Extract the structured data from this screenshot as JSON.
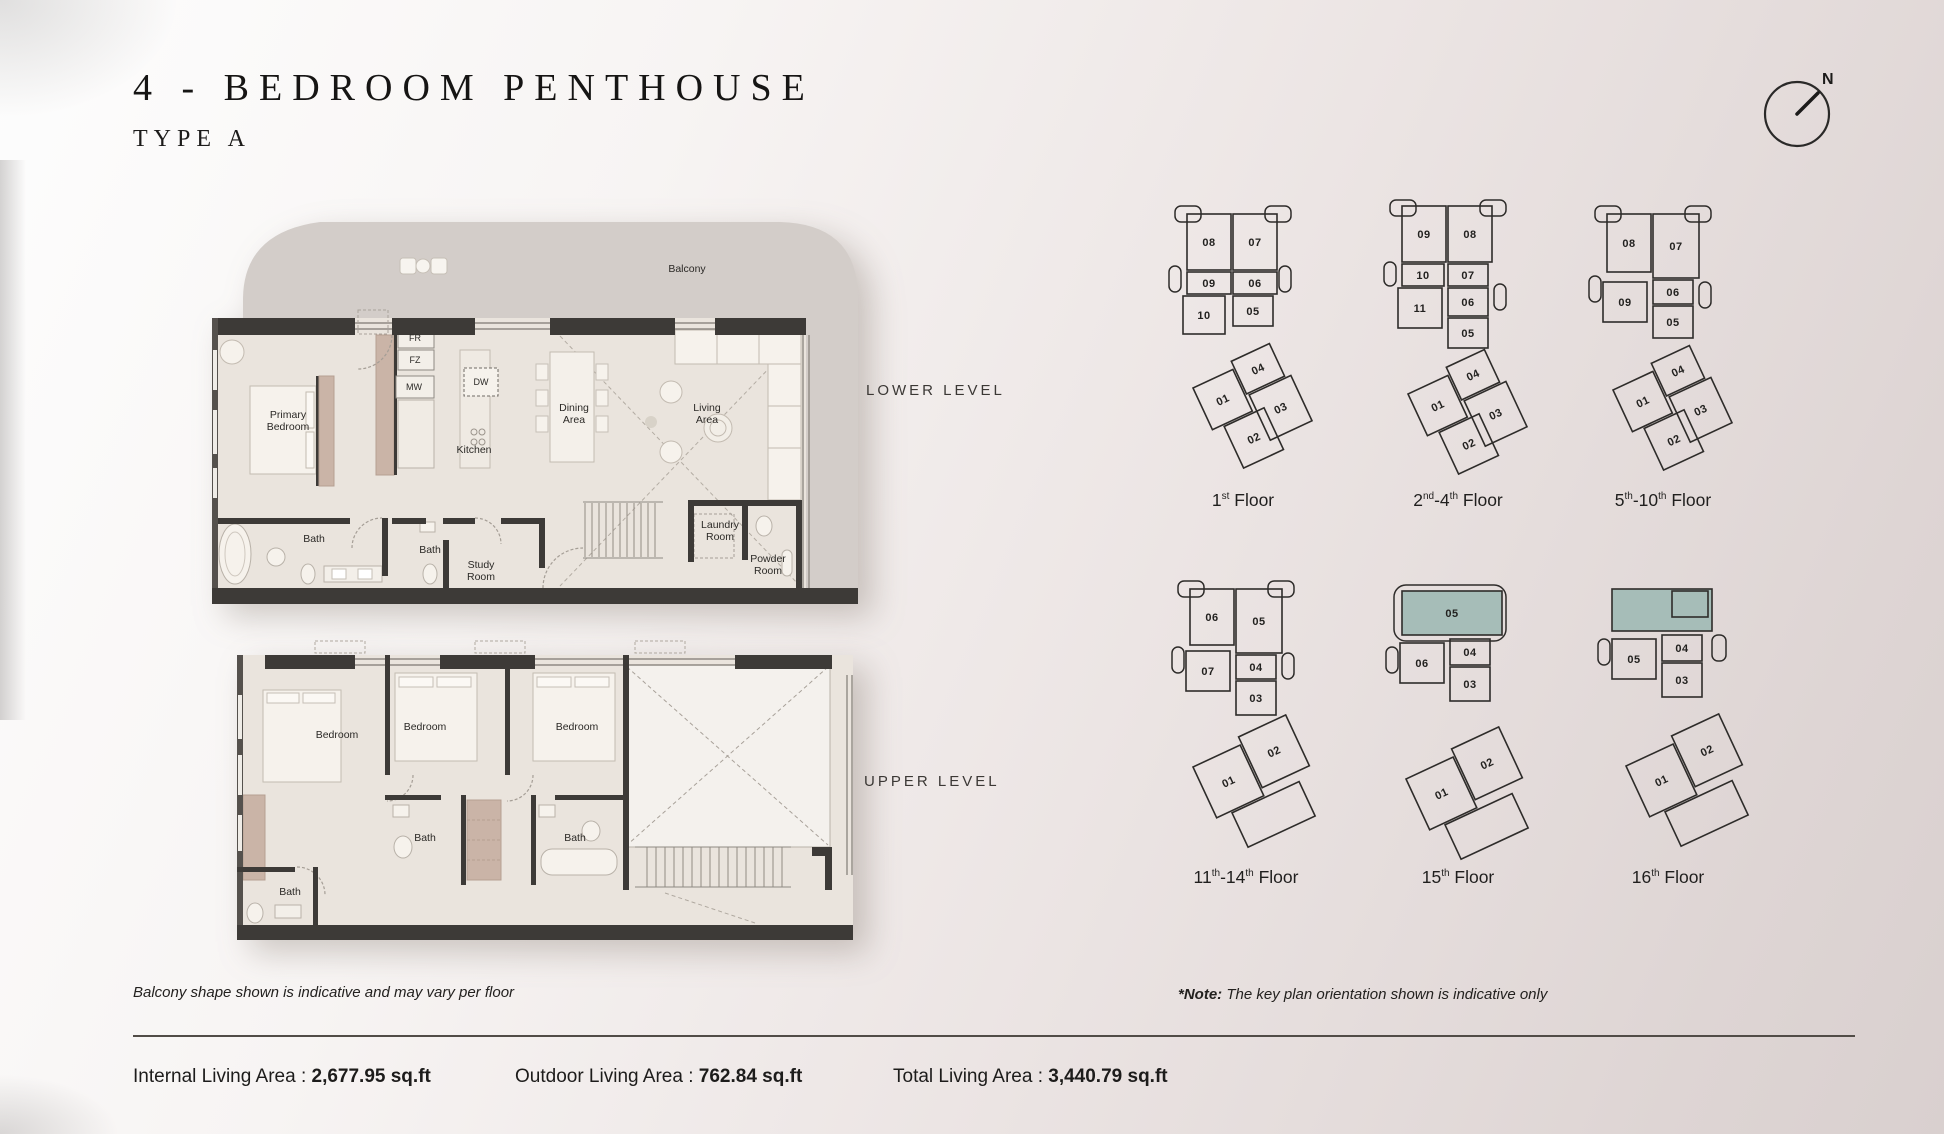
{
  "page": {
    "title": "4 - BEDROOM  PENTHOUSE",
    "subtitle": "TYPE A",
    "compass_label": "N"
  },
  "levels": {
    "lower": "LOWER LEVEL",
    "upper": "UPPER LEVEL"
  },
  "colors": {
    "highlight": "#a6bdb8",
    "wall": "#3d3a37",
    "floor": "#eae4dd",
    "balcony": "#d3cdc9",
    "stroke": "#2e2c2a"
  },
  "plans": {
    "lower": {
      "rooms": [
        {
          "label": "Balcony",
          "x": 557,
          "y": 69
        },
        {
          "label": "Primary\nBedroom",
          "x": 158,
          "y": 221
        },
        {
          "label": "FR",
          "x": 285,
          "y": 138,
          "cls": "sm"
        },
        {
          "label": "FZ",
          "x": 285,
          "y": 160,
          "cls": "sm"
        },
        {
          "label": "MW",
          "x": 284,
          "y": 187,
          "cls": "sm"
        },
        {
          "label": "DW",
          "x": 351,
          "y": 182,
          "cls": "sm"
        },
        {
          "label": "Kitchen",
          "x": 344,
          "y": 250
        },
        {
          "label": "Dining\nArea",
          "x": 444,
          "y": 214
        },
        {
          "label": "Living\nArea",
          "x": 577,
          "y": 214
        },
        {
          "label": "Bath",
          "x": 184,
          "y": 339
        },
        {
          "label": "Bath",
          "x": 300,
          "y": 350
        },
        {
          "label": "Study\nRoom",
          "x": 351,
          "y": 371
        },
        {
          "label": "Laundry\nRoom",
          "x": 590,
          "y": 331
        },
        {
          "label": "Powder\nRoom",
          "x": 638,
          "y": 365
        }
      ]
    },
    "upper": {
      "rooms": [
        {
          "label": "Bedroom",
          "x": 102,
          "y": 100
        },
        {
          "label": "Bedroom",
          "x": 190,
          "y": 92
        },
        {
          "label": "Bedroom",
          "x": 342,
          "y": 92
        },
        {
          "label": "Bath",
          "x": 190,
          "y": 203
        },
        {
          "label": "Bath",
          "x": 340,
          "y": 203
        },
        {
          "label": "Bath",
          "x": 55,
          "y": 257
        }
      ]
    }
  },
  "key_plans": [
    {
      "label": [
        {
          "t": "1",
          "s": "st"
        },
        {
          "t": " Floor"
        }
      ],
      "gu": "translate(20,8)",
      "bumps": [
        {
          "x": -8,
          "y": 0,
          "w": 26,
          "h": 16
        },
        {
          "x": 82,
          "y": 0,
          "w": 26,
          "h": 16
        },
        {
          "x": -14,
          "y": 60,
          "w": 12,
          "h": 26
        },
        {
          "x": 96,
          "y": 60,
          "w": 12,
          "h": 26
        }
      ],
      "upper": [
        {
          "n": "08",
          "x": 4,
          "y": 8,
          "w": 44,
          "h": 56
        },
        {
          "n": "07",
          "x": 50,
          "y": 8,
          "w": 44,
          "h": 56
        },
        {
          "n": "09",
          "x": 4,
          "y": 66,
          "w": 44,
          "h": 22
        },
        {
          "n": "06",
          "x": 50,
          "y": 66,
          "w": 44,
          "h": 22
        },
        {
          "n": "10",
          "x": 0,
          "y": 90,
          "w": 42,
          "h": 38
        },
        {
          "n": "05",
          "x": 50,
          "y": 90,
          "w": 40,
          "h": 30
        }
      ],
      "lp": "translate(30,190) rotate(-25)",
      "lower": [
        {
          "n": "01",
          "x": 0,
          "y": 0,
          "w": 44,
          "h": 46
        },
        {
          "n": "04",
          "x": 46,
          "y": -8,
          "w": 42,
          "h": 36
        },
        {
          "n": "02",
          "x": 12,
          "y": 48,
          "w": 44,
          "h": 46
        },
        {
          "n": "03",
          "x": 48,
          "y": 30,
          "w": 46,
          "h": 50
        }
      ]
    },
    {
      "label": [
        {
          "t": "2",
          "s": "nd"
        },
        {
          "t": "-4",
          "s": "th"
        },
        {
          "t": " Floor"
        }
      ],
      "gu": "translate(20,8)",
      "bumps": [
        {
          "x": -8,
          "y": -6,
          "w": 26,
          "h": 16
        },
        {
          "x": 82,
          "y": -6,
          "w": 26,
          "h": 16
        },
        {
          "x": -14,
          "y": 56,
          "w": 12,
          "h": 24
        },
        {
          "x": 96,
          "y": 78,
          "w": 12,
          "h": 26
        }
      ],
      "upper": [
        {
          "n": "09",
          "x": 4,
          "y": 0,
          "w": 44,
          "h": 56
        },
        {
          "n": "08",
          "x": 50,
          "y": 0,
          "w": 44,
          "h": 56
        },
        {
          "n": "10",
          "x": 4,
          "y": 58,
          "w": 42,
          "h": 22
        },
        {
          "n": "07",
          "x": 50,
          "y": 58,
          "w": 40,
          "h": 22
        },
        {
          "n": "11",
          "x": 0,
          "y": 82,
          "w": 44,
          "h": 40
        },
        {
          "n": "06",
          "x": 50,
          "y": 82,
          "w": 40,
          "h": 28
        },
        {
          "n": "05",
          "x": 50,
          "y": 112,
          "w": 40,
          "h": 30
        }
      ],
      "lp": "translate(30,196) rotate(-25)",
      "lower": [
        {
          "n": "01",
          "x": 0,
          "y": 0,
          "w": 44,
          "h": 46
        },
        {
          "n": "04",
          "x": 46,
          "y": -8,
          "w": 42,
          "h": 36
        },
        {
          "n": "02",
          "x": 12,
          "y": 48,
          "w": 44,
          "h": 46
        },
        {
          "n": "03",
          "x": 48,
          "y": 30,
          "w": 46,
          "h": 50
        }
      ]
    },
    {
      "label": [
        {
          "t": "5",
          "s": "th"
        },
        {
          "t": "-10",
          "s": "th"
        },
        {
          "t": " Floor"
        }
      ],
      "gu": "translate(20,8)",
      "bumps": [
        {
          "x": -8,
          "y": 0,
          "w": 26,
          "h": 16
        },
        {
          "x": 82,
          "y": 0,
          "w": 26,
          "h": 16
        },
        {
          "x": -14,
          "y": 70,
          "w": 12,
          "h": 26
        },
        {
          "x": 96,
          "y": 76,
          "w": 12,
          "h": 26
        }
      ],
      "upper": [
        {
          "n": "08",
          "x": 4,
          "y": 8,
          "w": 44,
          "h": 58
        },
        {
          "n": "07",
          "x": 50,
          "y": 8,
          "w": 46,
          "h": 64
        },
        {
          "n": "09",
          "x": 0,
          "y": 76,
          "w": 44,
          "h": 40
        },
        {
          "n": "06",
          "x": 50,
          "y": 74,
          "w": 40,
          "h": 24
        },
        {
          "n": "05",
          "x": 50,
          "y": 100,
          "w": 40,
          "h": 32
        }
      ],
      "lp": "translate(30,192) rotate(-25)",
      "lower": [
        {
          "n": "01",
          "x": 0,
          "y": 0,
          "w": 44,
          "h": 46
        },
        {
          "n": "04",
          "x": 46,
          "y": -8,
          "w": 42,
          "h": 36
        },
        {
          "n": "02",
          "x": 12,
          "y": 48,
          "w": 44,
          "h": 46
        },
        {
          "n": "03",
          "x": 48,
          "y": 30,
          "w": 46,
          "h": 50
        }
      ]
    },
    {
      "label": [
        {
          "t": "11",
          "s": "th"
        },
        {
          "t": "-14",
          "s": "th"
        },
        {
          "t": " Floor"
        }
      ],
      "gu": "translate(20,6)",
      "bumps": [
        {
          "x": -8,
          "y": 0,
          "w": 26,
          "h": 16
        },
        {
          "x": 82,
          "y": 0,
          "w": 26,
          "h": 16
        },
        {
          "x": -14,
          "y": 66,
          "w": 12,
          "h": 26
        },
        {
          "x": 96,
          "y": 72,
          "w": 12,
          "h": 26
        }
      ],
      "upper": [
        {
          "n": "06",
          "x": 4,
          "y": 8,
          "w": 44,
          "h": 56
        },
        {
          "n": "05",
          "x": 50,
          "y": 8,
          "w": 46,
          "h": 64
        },
        {
          "n": "07",
          "x": 0,
          "y": 70,
          "w": 44,
          "h": 40
        },
        {
          "n": "04",
          "x": 50,
          "y": 74,
          "w": 40,
          "h": 24
        },
        {
          "n": "03",
          "x": 50,
          "y": 100,
          "w": 40,
          "h": 34
        }
      ],
      "lp": "translate(27,192) rotate(-25)",
      "lower": [
        {
          "n": "01",
          "x": 0,
          "y": 0,
          "w": 52,
          "h": 56
        },
        {
          "n": "02",
          "x": 54,
          "y": -8,
          "w": 52,
          "h": 56
        },
        {
          "n": "",
          "x": 16,
          "y": 58,
          "w": 74,
          "h": 38
        }
      ]
    },
    {
      "label": [
        {
          "t": "15",
          "s": "th"
        },
        {
          "t": " Floor"
        }
      ],
      "gu": "translate(22,8)",
      "bumps": [
        {
          "x": -6,
          "y": 2,
          "w": 112,
          "h": 56,
          "rx": 12
        },
        {
          "x": -14,
          "y": 64,
          "w": 12,
          "h": 26
        }
      ],
      "upper": [
        {
          "n": "05",
          "x": 2,
          "y": 8,
          "w": 100,
          "h": 44,
          "hl": true
        },
        {
          "n": "06",
          "x": 0,
          "y": 60,
          "w": 44,
          "h": 40
        },
        {
          "n": "04",
          "x": 50,
          "y": 56,
          "w": 40,
          "h": 26
        },
        {
          "n": "03",
          "x": 50,
          "y": 84,
          "w": 40,
          "h": 34
        }
      ],
      "lp": "translate(28,204) rotate(-25)",
      "lower": [
        {
          "n": "01",
          "x": 0,
          "y": 0,
          "w": 52,
          "h": 56
        },
        {
          "n": "02",
          "x": 54,
          "y": -8,
          "w": 52,
          "h": 56
        },
        {
          "n": "",
          "x": 16,
          "y": 58,
          "w": 74,
          "h": 38
        }
      ]
    },
    {
      "label": [
        {
          "t": "16",
          "s": "th"
        },
        {
          "t": " Floor"
        }
      ],
      "gu": "translate(24,8)",
      "bumps": [
        {
          "x": -14,
          "y": 56,
          "w": 12,
          "h": 26
        },
        {
          "x": 100,
          "y": 52,
          "w": 14,
          "h": 26
        }
      ],
      "upper": [
        {
          "n": "",
          "x": 0,
          "y": 6,
          "w": 100,
          "h": 42,
          "hl": true
        },
        {
          "n": "",
          "x": 60,
          "y": 8,
          "w": 36,
          "h": 26
        },
        {
          "n": "05",
          "x": 0,
          "y": 56,
          "w": 44,
          "h": 40
        },
        {
          "n": "04",
          "x": 50,
          "y": 52,
          "w": 40,
          "h": 26
        },
        {
          "n": "03",
          "x": 50,
          "y": 80,
          "w": 40,
          "h": 34
        }
      ],
      "lp": "translate(38,191) rotate(-25)",
      "lower": [
        {
          "n": "01",
          "x": 0,
          "y": 0,
          "w": 52,
          "h": 56
        },
        {
          "n": "02",
          "x": 54,
          "y": -8,
          "w": 52,
          "h": 56
        },
        {
          "n": "",
          "x": 16,
          "y": 58,
          "w": 74,
          "h": 38
        }
      ]
    }
  ],
  "notes": {
    "balcony": "Balcony shape shown is indicative and may vary per floor",
    "keyplan_prefix": "*Note:",
    "keyplan_text": " The key plan orientation shown is indicative only"
  },
  "footer": {
    "items": [
      {
        "label": "Internal Living Area : ",
        "value": "2,677.95 sq.ft"
      },
      {
        "label": "Outdoor Living Area : ",
        "value": "762.84 sq.ft"
      },
      {
        "label": "Total Living Area : ",
        "value": "3,440.79 sq.ft"
      }
    ]
  }
}
